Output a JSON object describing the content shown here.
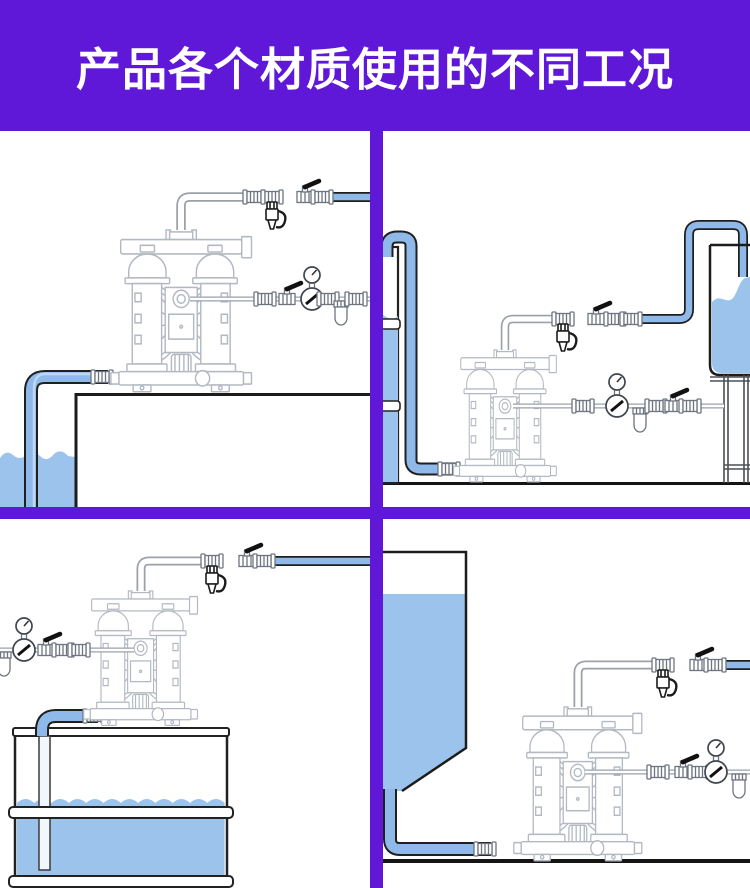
{
  "header": {
    "title": "产品各个材质使用的不同工况"
  },
  "colors": {
    "header_purple": "#5f17d8",
    "divider_purple": "#5f17d8",
    "pipe_blue": "#8fb9e9",
    "pipe_highlight": "#c3daf5",
    "water_blue": "#9cc3ec",
    "outline_dark": "#1f1f1f",
    "pump_gray": "#b3b9c2",
    "ground_dark": "#141414"
  },
  "panels": [
    {
      "position": "top-left"
    },
    {
      "position": "top-right"
    },
    {
      "position": "bottom-left"
    },
    {
      "position": "bottom-right"
    }
  ]
}
